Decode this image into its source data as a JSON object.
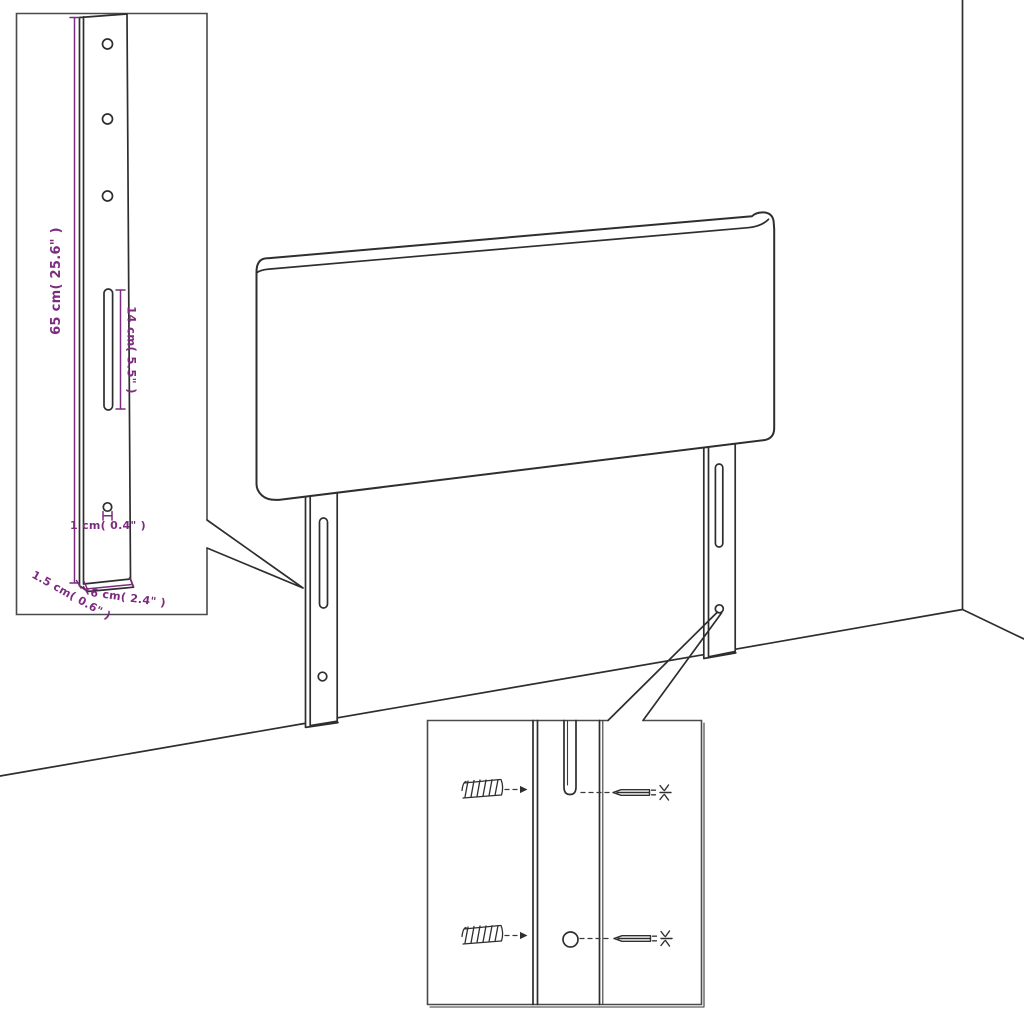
{
  "diagram": {
    "subject": "headboard-with-mounting-legs-dimension-diagram",
    "colors": {
      "background": "#ffffff",
      "line": "#2e2e2e",
      "inset_border": "#4a4a4a",
      "dimension_accent": "#7d2b80"
    },
    "leg_detail_inset": {
      "dimensions": {
        "leg_height": "65 cm( 25.6\" )",
        "slot_length": "14 cm( 5.5\" )",
        "hole_diameter": "1 cm( 0.4\" )",
        "leg_thickness": "1.5 cm( 0.6\" )",
        "leg_width": "6 cm( 2.4\" )"
      }
    },
    "mounting_detail_inset": {
      "parts": [
        "wall-plug",
        "wall-plug",
        "screw",
        "screw"
      ]
    }
  }
}
